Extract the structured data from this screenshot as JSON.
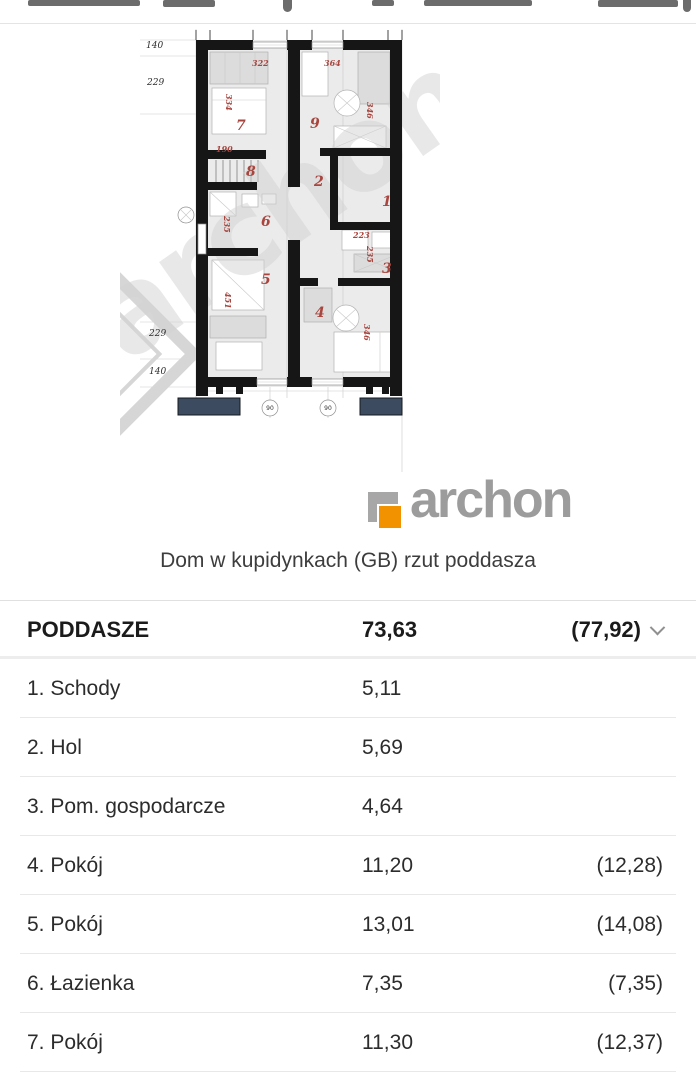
{
  "figure": {
    "caption": "Dom w kupidynkach (GB) rzut poddasza",
    "brand": {
      "logo_text": "archon",
      "orange": "#f29200",
      "gray": "#9c9c9c"
    }
  },
  "plan": {
    "watermark": "archon",
    "red_color": "#a8453e",
    "navy_color": "#3d4b61",
    "room_numbers": [
      {
        "t": "7",
        "x": 116,
        "y": 104
      },
      {
        "t": "9",
        "x": 190,
        "y": 102
      },
      {
        "t": "8",
        "x": 126,
        "y": 150
      },
      {
        "t": "2",
        "x": 194,
        "y": 160
      },
      {
        "t": "1",
        "x": 262,
        "y": 180
      },
      {
        "t": "6",
        "x": 141,
        "y": 200
      },
      {
        "t": "3",
        "x": 262,
        "y": 247
      },
      {
        "t": "5",
        "x": 141,
        "y": 258
      },
      {
        "t": "4",
        "x": 195,
        "y": 291
      }
    ],
    "red_dims": [
      {
        "t": "322",
        "x": 132,
        "y": 40,
        "r": 0
      },
      {
        "t": "364",
        "x": 204,
        "y": 40,
        "r": 0
      },
      {
        "t": "334",
        "x": 106,
        "y": 68,
        "r": 90
      },
      {
        "t": "346",
        "x": 247,
        "y": 76,
        "r": 90
      },
      {
        "t": "190",
        "x": 96,
        "y": 126,
        "r": 0
      },
      {
        "t": "235",
        "x": 104,
        "y": 190,
        "r": 90
      },
      {
        "t": "223",
        "x": 233,
        "y": 212,
        "r": 0
      },
      {
        "t": "235",
        "x": 247,
        "y": 220,
        "r": 90
      },
      {
        "t": "451",
        "x": 105,
        "y": 266,
        "r": 90
      },
      {
        "t": "346",
        "x": 244,
        "y": 298,
        "r": 90
      }
    ],
    "black_dims": [
      {
        "t": "140",
        "x": 26,
        "y": 22
      },
      {
        "t": "229",
        "x": 27,
        "y": 59
      },
      {
        "t": "229",
        "x": 29,
        "y": 310
      },
      {
        "t": "140",
        "x": 29,
        "y": 348
      }
    ],
    "circle_labels": [
      {
        "t": "90",
        "x": 150,
        "y": 384
      },
      {
        "t": "90",
        "x": 208,
        "y": 384
      }
    ]
  },
  "table": {
    "header": {
      "name": "PODDASZE",
      "area": "73,63",
      "gross": "(77,92)"
    },
    "rows": [
      {
        "name": "1. Schody",
        "area": "5,11",
        "gross": ""
      },
      {
        "name": "2. Hol",
        "area": "5,69",
        "gross": ""
      },
      {
        "name": "3. Pom. gospodarcze",
        "area": "4,64",
        "gross": ""
      },
      {
        "name": "4. Pokój",
        "area": "11,20",
        "gross": "(12,28)"
      },
      {
        "name": "5. Pokój",
        "area": "13,01",
        "gross": "(14,08)"
      },
      {
        "name": "6. Łazienka",
        "area": "7,35",
        "gross": "(7,35)"
      },
      {
        "name": "7. Pokój",
        "area": "11,30",
        "gross": "(12,37)"
      }
    ]
  }
}
